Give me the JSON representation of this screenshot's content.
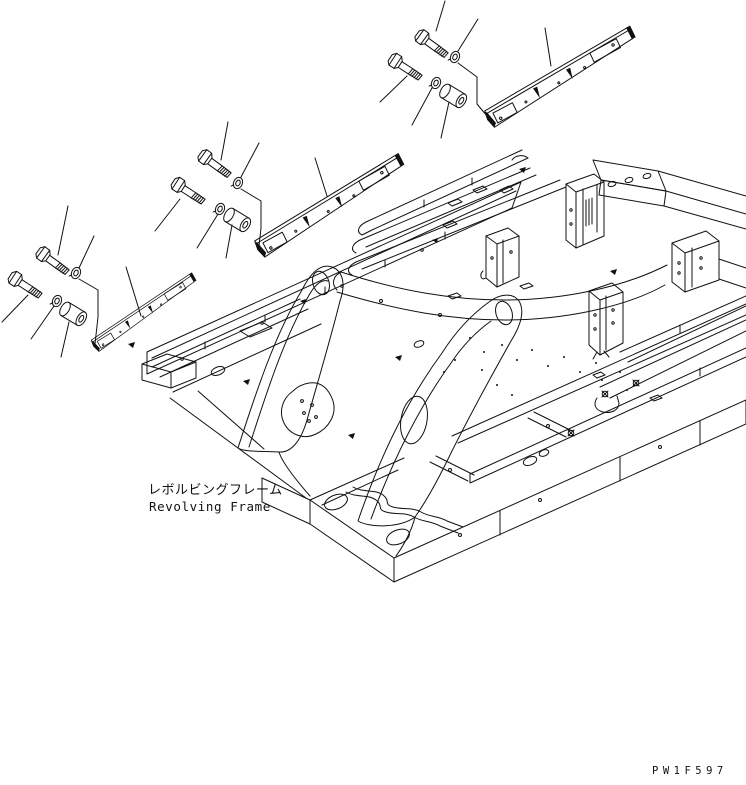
{
  "page": {
    "background_color": "#ffffff",
    "line_color": "#111111"
  },
  "labels": {
    "frame_label_jp": "レボルビングフレーム",
    "frame_label_en": "Revolving Frame",
    "drawing_code": "PW1F597"
  },
  "diagram": {
    "type": "exploded-parts-line-drawing",
    "assembly": "revolving-frame",
    "exploded_groups": [
      {
        "location": "upper-left",
        "components": [
          "bolt",
          "bolt",
          "washer",
          "washer",
          "spacer",
          "cover-strip"
        ]
      },
      {
        "location": "upper-middle",
        "components": [
          "bolt",
          "bolt",
          "washer",
          "washer",
          "spacer",
          "cover-strip"
        ]
      },
      {
        "location": "top-center",
        "components": [
          "bolt",
          "bolt",
          "washer",
          "washer",
          "spacer",
          "cover-strip"
        ]
      }
    ]
  }
}
